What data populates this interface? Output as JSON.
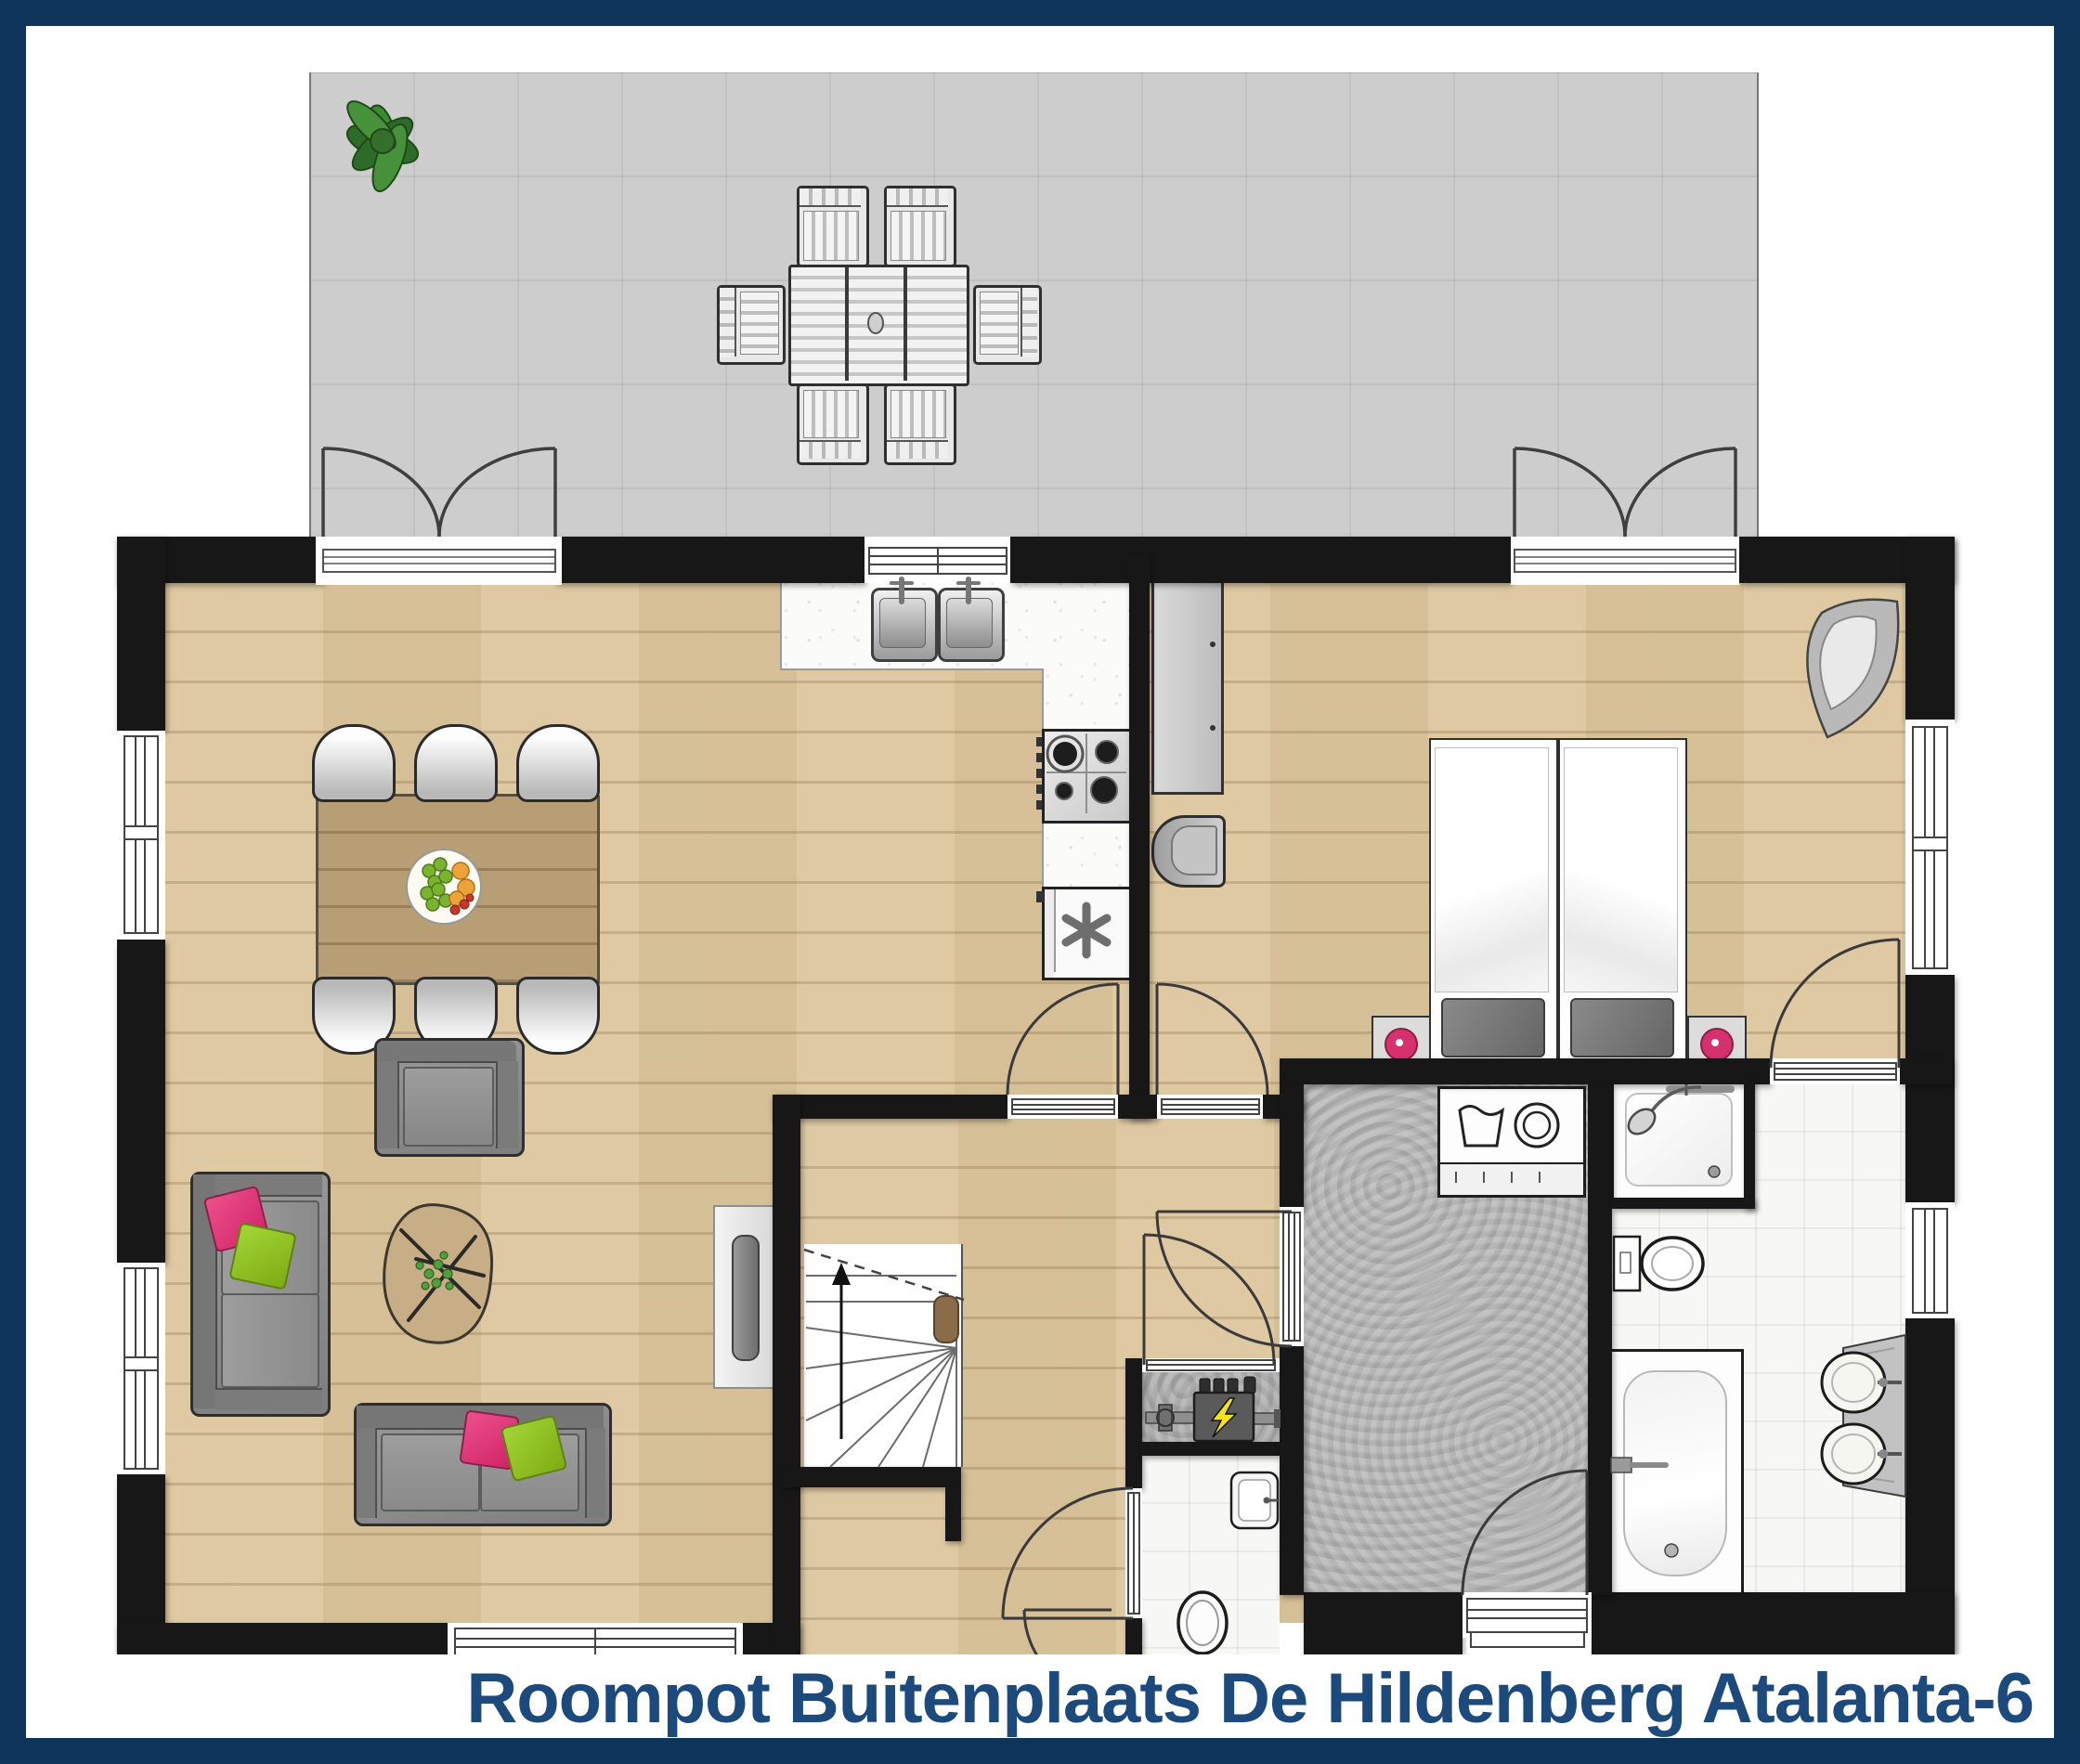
{
  "title": "Roompot Buitenplaats De Hildenberg Atalanta-6",
  "theme": {
    "navy": "#0e3459",
    "title": "#1c4a7c",
    "wall": "#171717",
    "wood": "#dcc69e",
    "terrace_gray": "#cdcdcd",
    "utility_gray": "#b6b6b6",
    "tile_white": "#f7f7f5",
    "sofa_gray": "#8b8b8b",
    "pillow_pink": "#e23577",
    "pillow_green": "#93c71f",
    "clock_pink": "#d6316e",
    "bolt_yellow": "#f3e11c",
    "plant_green": "#3e8a33",
    "table_wood": "#b79e75"
  },
  "icons": {
    "freezer-icon": "✳",
    "electric-bolt-icon": "⚡",
    "washing-machine-icon": "◯",
    "laundry-tub-icon": "wash-tub",
    "stairs-up-arrow-icon": "↑",
    "plant-icon": "❀",
    "shower-head-icon": "shower",
    "fruit-bowl-icon": "fruit"
  }
}
